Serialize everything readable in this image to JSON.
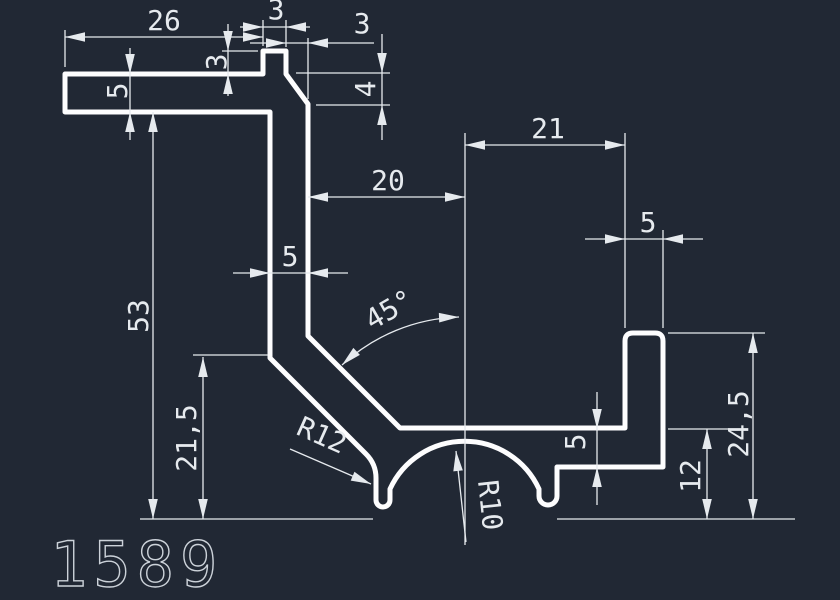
{
  "drawing": {
    "part_number": "1589",
    "colors": {
      "background": "#212834",
      "profile_line": "#fdfdfe",
      "dimension_line": "#e6eaee",
      "part_number_line": "#ccd2d9"
    },
    "dimensions": {
      "flange_width": "26",
      "top_tab_width": "3",
      "chamfer_run": "3",
      "top_tab_height": "3",
      "chamfer_drop": "4",
      "flange_thickness": "5",
      "overall_height": "53",
      "leg_height": "21,5",
      "web_to_center": "20",
      "center_to_tab": "21",
      "web_thickness": "5",
      "right_tab_width": "5",
      "angle": "45°",
      "hook_radius": "R12",
      "arch_radius": "R10",
      "base_thickness": "5",
      "hook_height": "12",
      "right_tab_height": "24,5"
    }
  }
}
